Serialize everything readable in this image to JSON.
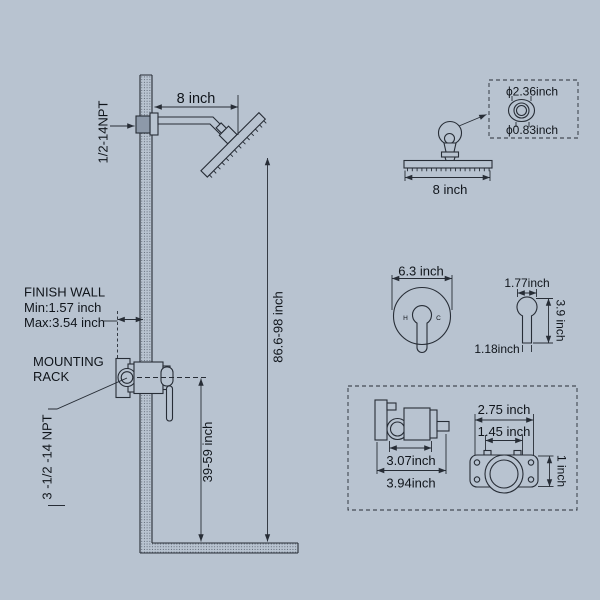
{
  "colors": {
    "background": "#b8c3d0",
    "line": "#272d36",
    "text": "#10151b",
    "connector_fill": "#8d99a9"
  },
  "labels": {
    "npt_arm": "1/2-14NPT",
    "dim_arm": "8 inch",
    "finish_wall": "FINISH WALL",
    "finish_min": "Min:1.57 inch",
    "finish_max": "Max:3.54 inch",
    "mounting1": "MOUNTING",
    "mounting2": "RACK",
    "npt_valve": "3 -1/2 -14 NPT",
    "dim_valve_height": "39-59 inch",
    "dim_head_height": "86.6-98 inch",
    "detail_outer": "ϕ2.36inch",
    "detail_inner": "ϕ0.83inch",
    "dim_head_width": "8 inch",
    "dim_trim": "6.3 inch",
    "hot": "H",
    "cold": "C",
    "dim_handle_w": "1.77inch",
    "dim_handle_h": "3.9 inch",
    "dim_handle_base": "1.18inch",
    "dim_rough_body": "3.07inch",
    "dim_rough_total": "3.94inch",
    "dim_plate_w": "2.75 inch",
    "dim_holes": "1.45 inch",
    "dim_plate_h": "1 inch"
  }
}
